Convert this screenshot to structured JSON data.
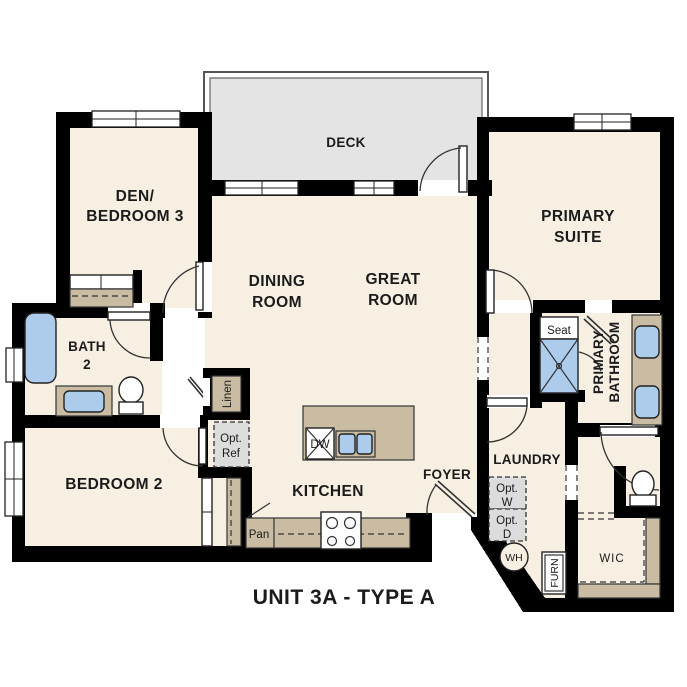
{
  "title": "UNIT 3A - TYPE A",
  "colors": {
    "wall": "#000000",
    "floor": "#F6EFE2",
    "deck": "#E4E4E4",
    "counter_tan": "#C9BCA2",
    "fixture_blue": "#ADCBEB",
    "optional_gray": "#DCDCDC",
    "line": "#333333"
  },
  "rooms": {
    "deck": {
      "label": "DECK"
    },
    "den_bedroom3": {
      "line1": "DEN/",
      "line2": "BEDROOM 3"
    },
    "dining_room": {
      "line1": "DINING",
      "line2": "ROOM"
    },
    "great_room": {
      "line1": "GREAT",
      "line2": "ROOM"
    },
    "primary_suite": {
      "line1": "PRIMARY",
      "line2": "SUITE"
    },
    "primary_bathroom": {
      "line1": "PRIMARY",
      "line2": "BATHROOM"
    },
    "bath_2": {
      "line1": "BATH",
      "line2": "2"
    },
    "bedroom_2": {
      "label": "BEDROOM 2"
    },
    "kitchen": {
      "label": "KITCHEN"
    },
    "foyer": {
      "label": "FOYER"
    },
    "laundry": {
      "label": "LAUNDRY"
    },
    "wic": {
      "label": "WIC"
    }
  },
  "fixtures": {
    "shower_seat": {
      "label": "Seat"
    },
    "linen_closet": {
      "label": "Linen"
    },
    "pantry": {
      "label": "Pan"
    },
    "dishwasher": {
      "label": "DW"
    },
    "water_heater": {
      "label": "WH"
    },
    "furnace": {
      "label": "FURN"
    },
    "opt_refrigerator": {
      "line1": "Opt.",
      "line2": "Ref"
    },
    "opt_washer": {
      "line1": "Opt.",
      "line2": "W"
    },
    "opt_dryer": {
      "line1": "Opt.",
      "line2": "D"
    }
  }
}
